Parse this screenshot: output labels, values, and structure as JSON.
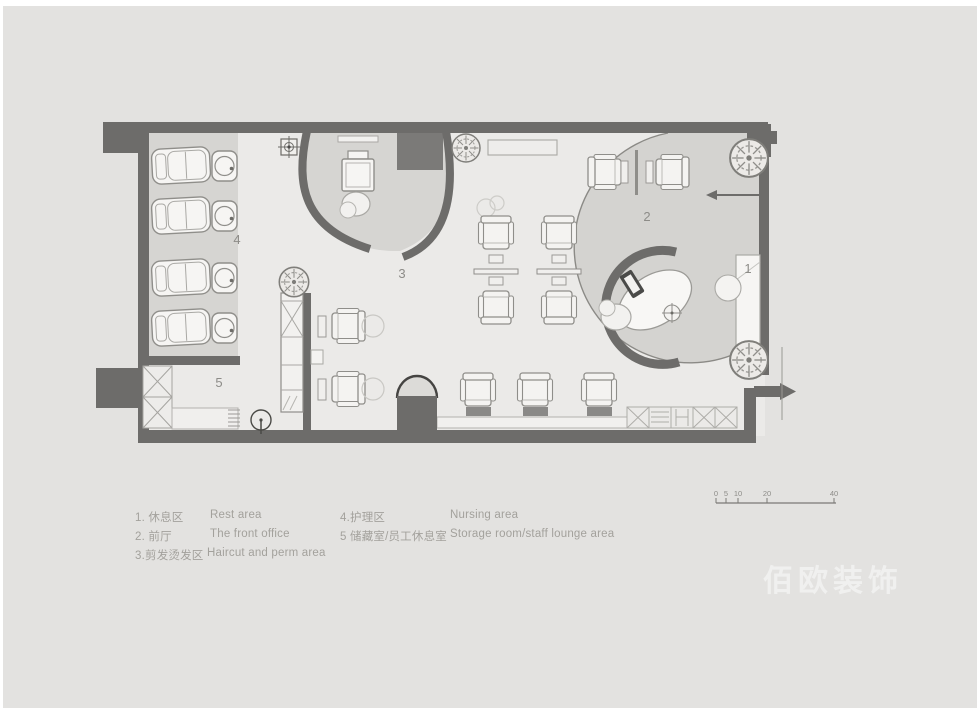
{
  "plan": {
    "room_labels": [
      "1",
      "2",
      "3",
      "4",
      "5"
    ]
  },
  "legend": {
    "items": [
      {
        "zh": "1. 休息区",
        "en": "Rest area"
      },
      {
        "zh": "2. 前厅",
        "en": "The front office"
      },
      {
        "zh": "3.剪发烫发区",
        "en": "Haircut and perm area"
      },
      {
        "zh": "4.护理区",
        "en": "Nursing area"
      },
      {
        "zh": "5 储藏室/员工休息室",
        "en": "Storage room/staff lounge area"
      }
    ]
  },
  "scale_bar": {
    "labels": [
      "0",
      "5",
      "10",
      "20",
      "40"
    ]
  },
  "watermark": "佰欧装饰",
  "colors": {
    "canvas_bg": "#e3e2e0",
    "floor": "#ebeae8",
    "shaded_zone": "#d6d5d2",
    "wall": "#6d6c6a",
    "furniture_stroke": "#8f8e8a",
    "label_text": "#8d8c88",
    "legend_text": "#a3a19c"
  }
}
